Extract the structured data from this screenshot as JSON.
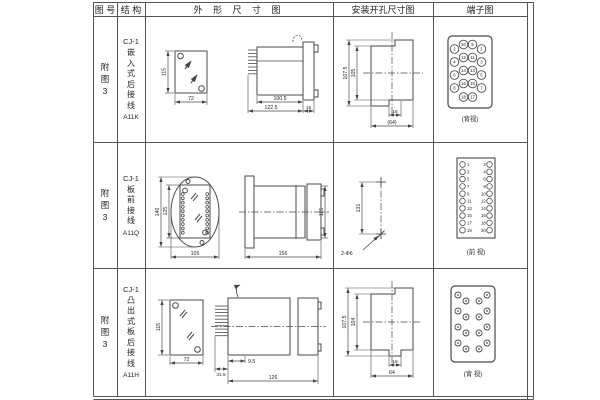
{
  "header": {
    "col_figure": "图 号",
    "col_structure": "结 构",
    "col_outline": "外 形 尺 寸 图",
    "col_mounting": "安装开孔尺寸图",
    "col_terminal": "端子图"
  },
  "rows": [
    {
      "figure": "附\n图\n3",
      "model": "CJ-1",
      "desc": "嵌\n入\n式\n后\n接\n线",
      "code": "A11K",
      "outline": {
        "front_height": "115",
        "front_width": "72",
        "side_body": "100.5",
        "side_total": "122.5",
        "side_flange": "15"
      },
      "mounting": {
        "outer_height": "107.5",
        "inner_height": "105",
        "hole_pitch": "16",
        "width": "(64)"
      },
      "terminal": {
        "caption": "(背视)",
        "nums": [
          "2",
          "4",
          "6",
          "8",
          "10",
          "12",
          "14",
          "16",
          "9",
          "11",
          "13",
          "15",
          "1",
          "3",
          "5",
          "7",
          "18",
          "17"
        ]
      }
    },
    {
      "figure": "附\n图\n3",
      "model": "CJ-1",
      "desc": "板\n前\n接\n线",
      "code": "A11Q",
      "outline": {
        "front_outer": "140",
        "front_inner": "125",
        "front_width": "105",
        "side_length": "156",
        "side_height": "115"
      },
      "mounting": {
        "height": "131",
        "holes": "2-Φ6"
      },
      "terminal": {
        "caption": "(前 视)",
        "left": [
          "1",
          "3",
          "5",
          "7",
          "9",
          "11",
          "13",
          "15",
          "17",
          "19"
        ],
        "right": [
          "2",
          "4",
          "6",
          "8",
          "10",
          "12",
          "14",
          "16",
          "18",
          "20"
        ]
      }
    },
    {
      "figure": "附\n图\n3",
      "model": "CJ-1",
      "desc": "凸\n出\n式\n板\n后\n接\n线",
      "code": "A11H",
      "outline": {
        "front_height": "115",
        "front_width": "72",
        "side_pins": "31.5",
        "side_gap": "9.5",
        "side_length": "126"
      },
      "mounting": {
        "outer_height": "107.5",
        "inner_height": "104",
        "hole_pitch": "16",
        "width": "64"
      },
      "terminal": {
        "caption": "(背 视)"
      }
    }
  ]
}
